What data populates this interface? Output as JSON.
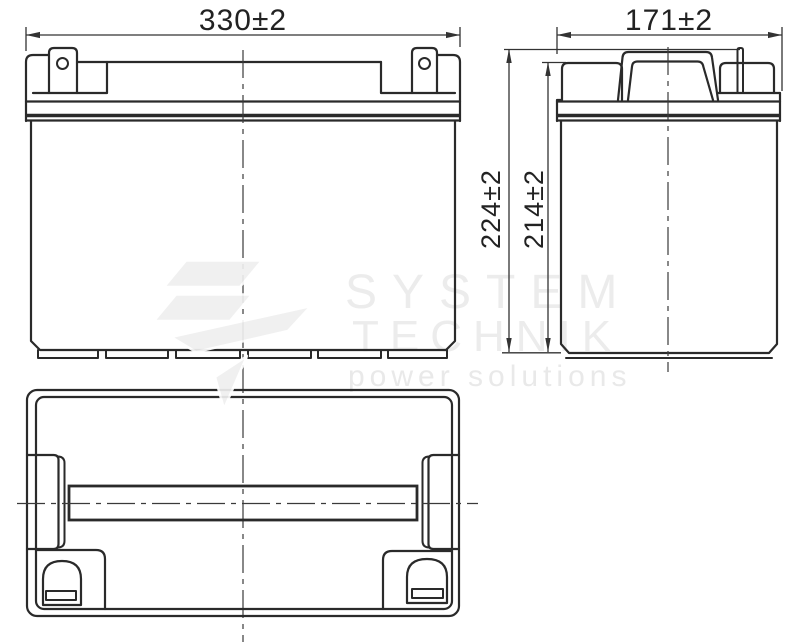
{
  "views": {
    "front": {
      "width_dim": "330±2"
    },
    "side": {
      "width_dim": "171±2",
      "overall_height_dim": "224±2",
      "case_height_dim": "214±2"
    }
  },
  "watermark": {
    "brand_line1": "SYSTEM",
    "brand_line2": "TECHNIK",
    "tagline": "power solutions"
  },
  "colors": {
    "line": "#2a2a2a",
    "background": "#ffffff",
    "watermark_text": "#ececec",
    "watermark_logo": "#efefef"
  }
}
